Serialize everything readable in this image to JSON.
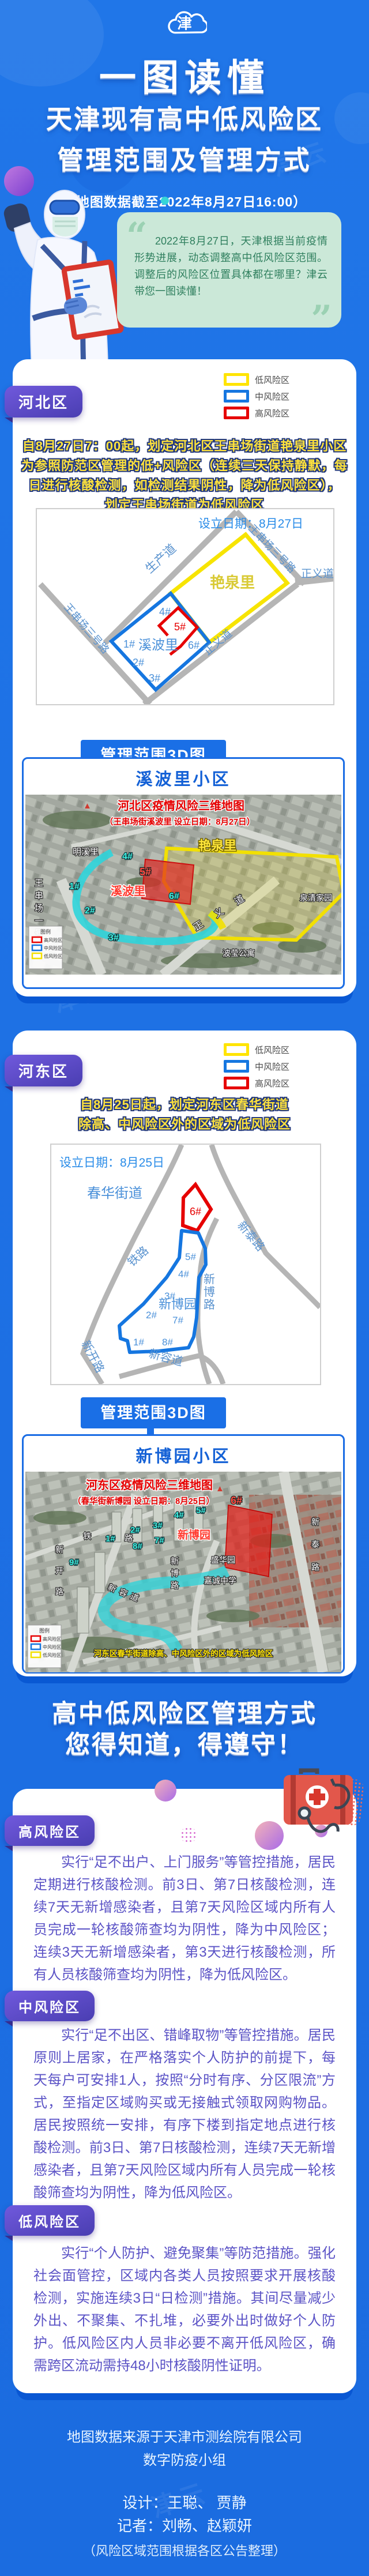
{
  "brand": {
    "watermark": "津云",
    "logo_char": "津"
  },
  "header": {
    "t1": "一图读懂",
    "t2": "天津现有高中低风险区",
    "t3": "管理范围及管理方式",
    "sub": "（地图数据截至2022年8月27日16:00）",
    "quote": "2022年8月27日，天津根据当前疫情形势进展，动态调整高中低风险区范围。调整后的风险区位置具体都在哪里？津云带您一图读懂！"
  },
  "legend": {
    "low": "低风险区",
    "mid": "中风险区",
    "high": "高风险区"
  },
  "d1": {
    "name": "河北区",
    "notice": "自8月27日7：00起，划定河北区王串场街道艳泉里小区\n为参照防范区管理的低+风险区（连续三天保持静默，每\n日进行核酸检测，如检测结果阴性，降为低风险区），\n划定王串场街道为低风险区",
    "map": {
      "date": "设立日期：8月27日",
      "low_area": "艳泉里",
      "mid_area": "溪波里",
      "b1": "1#",
      "b2": "2#",
      "b3": "3#",
      "b4": "4#",
      "b5": "5#",
      "b6": "6#",
      "road1": "生产道",
      "road2": "王串场三号路",
      "road3": "王串场三号路",
      "road4": "正义道",
      "road5": "正义道"
    },
    "banner": "管理范围3D图",
    "photo": {
      "title": "溪波里小区",
      "cap1": "河北区疫情风险三维地图",
      "cap2": "（王串场街溪波里 设立日期：8月27日）",
      "mingxili": "明溪里",
      "yanquanli": "艳泉里",
      "xiboli": "溪波里",
      "quanqing": "泉清家园",
      "boying": "波莹公寓",
      "b1": "1#",
      "b2": "2#",
      "b3": "3#",
      "b4": "4#",
      "b5": "5#",
      "b6": "6#",
      "road_v": "王串场一号路",
      "road_zy": "正义道",
      "lg_title": "图例",
      "lg_high": "高风险区",
      "lg_mid": "中风险区",
      "lg_low": "低风险区"
    }
  },
  "d2": {
    "name": "河东区",
    "notice": "自8月25日起，划定河东区春华街道\n除高、中风险区外的区域为低风险区",
    "map": {
      "date": "设立日期：8月25日",
      "street": "春华街道",
      "community": "新博园",
      "b1": "1#",
      "b2": "2#",
      "b3": "3#",
      "b4": "4#",
      "b5": "5#",
      "b6": "6#",
      "b7": "7#",
      "b8": "8#",
      "road1": "铁路",
      "road2": "新泰路",
      "road3": "新博路",
      "road4": "新容道",
      "road5": "新开路"
    },
    "banner": "管理范围3D图",
    "photo": {
      "title": "新博园小区",
      "cap1": "河东区疫情风险三维地图",
      "cap2": "（春华街新博园 设立日期：8月25日）",
      "xinboyuan": "新博园",
      "shenghua": "盛华园",
      "jiacheng": "嘉诚中学",
      "b1": "1#",
      "b2": "2#",
      "b3": "3#",
      "b4": "4#",
      "b5": "5#",
      "b6": "6#",
      "b7": "7#",
      "b8": "8#",
      "b9": "9#",
      "road_tie": "铁路",
      "road_xintai": "新泰路",
      "road_xinbo": "新博路",
      "road_xinrong": "新容道",
      "road_xinkai": "新开路",
      "note": "河东区春华街道除高、中风险区外的区域为低风险区",
      "lg_title": "图例",
      "lg_high": "高风险区",
      "lg_mid": "中风险区",
      "lg_low": "低风险区"
    }
  },
  "rules": {
    "t1": "高中低风险区管理方式",
    "t2": "您得知道，得遵守！",
    "items": [
      {
        "label": "高风险区",
        "text": "实行“足不出户、上门服务”等管控措施，居民定期进行核酸检测。前3日、第7日核酸检测，连续7天无新增感染者，且第7天风险区域内所有人员完成一轮核酸筛查均为阴性，降为中风险区；连续3天无新增感染者，第3天进行核酸检测，所有人员核酸筛查均为阴性，降为低风险区。"
      },
      {
        "label": "中风险区",
        "text": "实行“足不出区、错峰取物”等管控措施。居民原则上居家，在严格落实个人防护的前提下，每天每户可安排1人，按照“分时有序、分区限流”方式，至指定区域购买或无接触式领取网购物品。居民按照统一安排，有序下楼到指定地点进行核酸检测。前3日、第7日核酸检测，连续7天无新增感染者，且第7天风险区域内所有人员完成一轮核酸筛查均为阴性，降为低风险区。"
      },
      {
        "label": "低风险区",
        "text": "实行“个人防护、避免聚集”等防范措施。强化社会面管控，区域内各类人员按照要求开展核酸检测，实施连续3日“日检测”措施。其间尽量减少外出、不聚集、不扎堆，必要外出时做好个人防护。低风险区内人员非必要不离开低风险区，确需跨区流动需持48小时核酸阴性证明。"
      }
    ]
  },
  "footer": {
    "src1": "地图数据来源于天津市测绘院有限公司",
    "src2": "数字防疫小组",
    "design": "设计：王聪、 贾静",
    "reporter": "记者：刘畅、赵颖妍",
    "note": "（风险区域范围根据各区公告整理）"
  }
}
